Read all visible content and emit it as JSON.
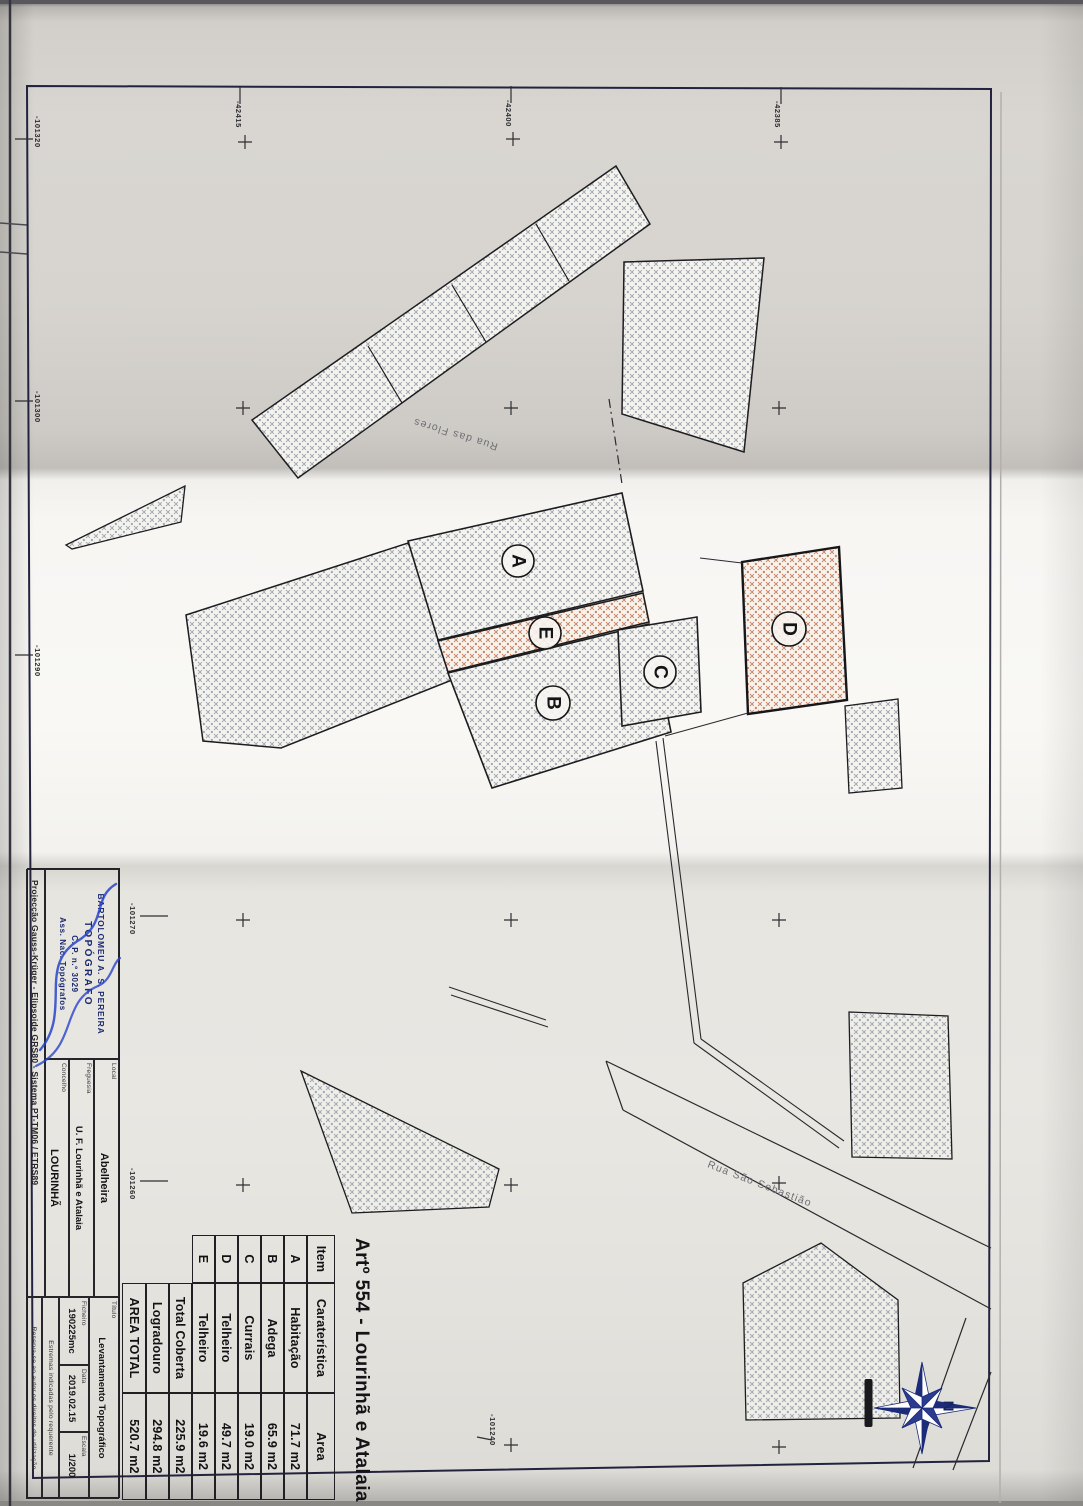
{
  "sheet": {
    "title": "Artº 554 - Lourinhã e Atalaia"
  },
  "table": {
    "headers": [
      "Item",
      "Caraterística",
      "Area"
    ],
    "rows": [
      [
        "A",
        "Habitação",
        "71.7 m2"
      ],
      [
        "B",
        "Adega",
        "65.9 m2"
      ],
      [
        "C",
        "Currais",
        "19.0 m2"
      ],
      [
        "D",
        "Telheiro",
        "49.7 m2"
      ],
      [
        "E",
        "Telheiro",
        "19.6 m2"
      ]
    ],
    "summary": [
      [
        "Total Coberta",
        "225.9 m2"
      ],
      [
        "Logradouro",
        "294.8 m2"
      ],
      [
        "AREA TOTAL",
        "520.7 m2"
      ]
    ]
  },
  "title_block": {
    "stamp": {
      "name": "BARTOLOMEU A. S. PEREIRA",
      "role": "TOPÓGRAFO",
      "number": "C. P. n.º 3029",
      "org": "Ass. Nac. Topógrafos"
    },
    "fields": [
      {
        "label": "Local",
        "value": "Abelheira"
      },
      {
        "label": "Freguesia",
        "value": "U. F. Lourinhã e Atalaia"
      },
      {
        "label": "Concelho",
        "value": "LOURINHÃ"
      },
      {
        "label": "Título",
        "value": "Levantamento Topográfico"
      },
      {
        "label": "Ficheiro",
        "value": "190225mc"
      },
      {
        "label": "Data",
        "value": "2019.02.15"
      },
      {
        "label": "Escala",
        "value": "1/200"
      }
    ],
    "projection": "Projecção Gauss-Krüger - Elipsoide GRS80 - Sistema PT-TM06 / ETRS89",
    "notes": [
      "Estremas indicadas pelo requerente",
      "Reserva-se ao autor os direitos de utilização"
    ]
  },
  "map": {
    "streets": [
      "Rua das Flores",
      "Rua São Sebastião"
    ],
    "building_letters": [
      "A",
      "E",
      "B",
      "C",
      "D"
    ],
    "coords_left": [
      "-101320",
      "-101300",
      "-101290",
      "-101270",
      "-101260"
    ],
    "coords_top": [
      "-42415",
      "-42400",
      "-42385"
    ],
    "coord_interior": "-101240",
    "compass_north": "N"
  },
  "colors": {
    "hatch_gray": "#99a1ad",
    "hatch_orange": "#c07a58",
    "stamp_navy": "#1b2a70",
    "signature_blue": "#2743c9",
    "compass_navy": "#1c2b7a"
  }
}
